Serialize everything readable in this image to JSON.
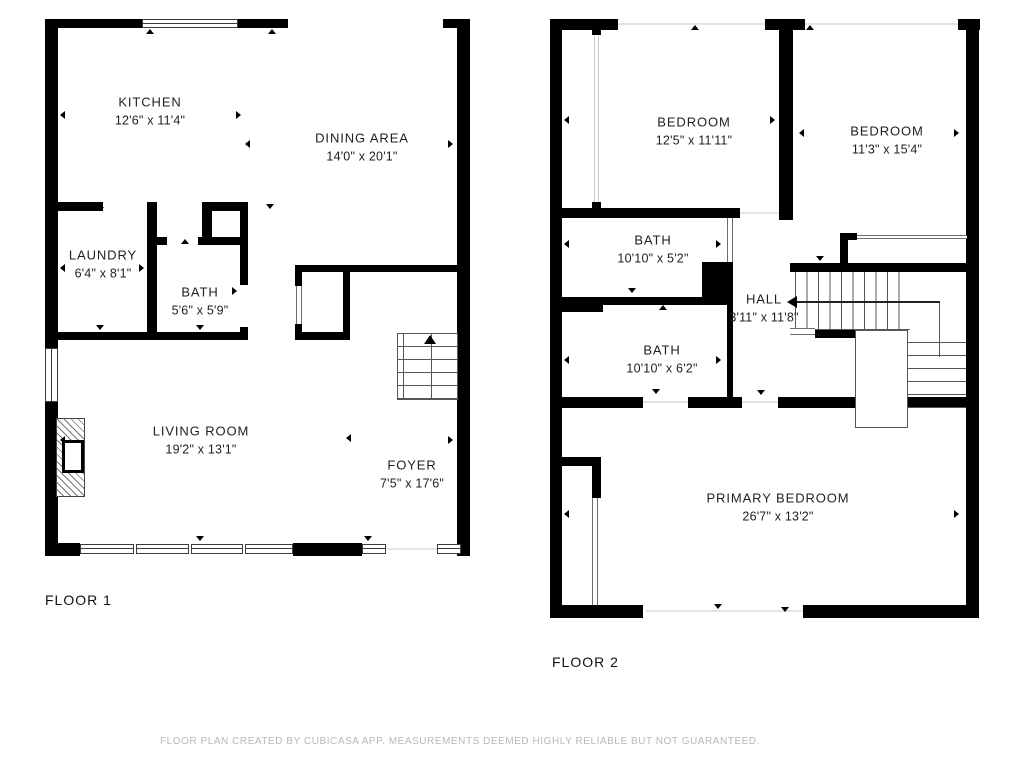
{
  "floor1": {
    "label": "FLOOR 1",
    "rooms": [
      {
        "name": "KITCHEN",
        "dims": "12'6\" x 11'4\""
      },
      {
        "name": "DINING AREA",
        "dims": "14'0\" x 20'1\""
      },
      {
        "name": "LAUNDRY",
        "dims": "6'4\" x 8'1\""
      },
      {
        "name": "BATH",
        "dims": "5'6\" x 5'9\""
      },
      {
        "name": "LIVING ROOM",
        "dims": "19'2\" x 13'1\""
      },
      {
        "name": "FOYER",
        "dims": "7'5\" x 17'6\""
      }
    ]
  },
  "floor2": {
    "label": "FLOOR 2",
    "rooms": [
      {
        "name": "BEDROOM",
        "dims": "12'5\" x 11'11\""
      },
      {
        "name": "BEDROOM",
        "dims": "11'3\" x 15'4\""
      },
      {
        "name": "BATH",
        "dims": "10'10\" x 5'2\""
      },
      {
        "name": "HALL",
        "dims": "3'11\" x 11'8\""
      },
      {
        "name": "BATH",
        "dims": "10'10\" x 6'2\""
      },
      {
        "name": "PRIMARY BEDROOM",
        "dims": "26'7\" x 13'2\""
      }
    ]
  },
  "footer": {
    "disclaimer": "FLOOR PLAN CREATED BY CUBICASA APP. MEASUREMENTS DEEMED HIGHLY RELIABLE BUT NOT GUARANTEED."
  },
  "icons": {
    "stairs_up_arrow": "triangle-up",
    "stairs_direction_arrow": "triangle-left",
    "measure_marker": "small-triangle"
  },
  "colors": {
    "wall": "#000000",
    "stair_line": "#555555",
    "window_line": "#3c3c3c",
    "faint_opening": "#e4e4e4",
    "room_text": "#1f1f1f",
    "disclaimer_text": "#b8b8b8",
    "background": "#ffffff"
  }
}
